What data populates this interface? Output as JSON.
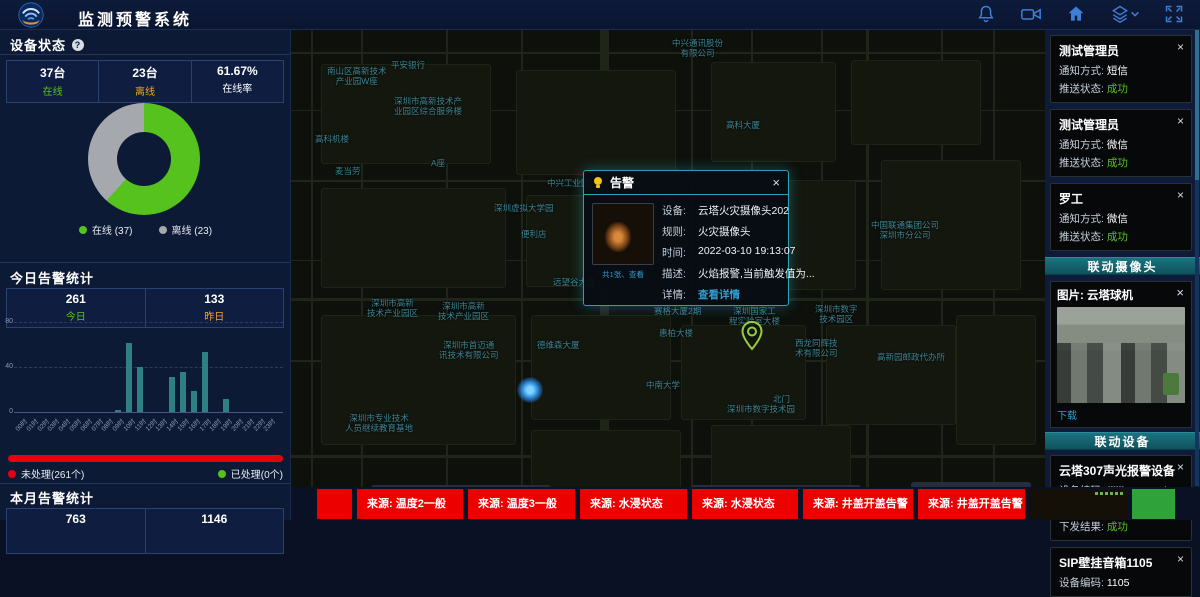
{
  "ui": {
    "close_glyph": "×",
    "help_glyph": "?"
  },
  "header": {
    "title": "监测预警系统",
    "icons": [
      "bell-icon",
      "video-camera-icon",
      "home-icon",
      "layers-icon",
      "fullscreen-icon"
    ]
  },
  "device_status": {
    "title": "设备状态",
    "stats": [
      {
        "value": "37台",
        "label": "在线",
        "label_color": "#56c21d"
      },
      {
        "value": "23台",
        "label": "离线",
        "label_color": "#f5a623"
      },
      {
        "value": "61.67%",
        "label": "在线率",
        "label_color": "#ffffff"
      }
    ],
    "chart_data": {
      "type": "pie",
      "labels": [
        "在线",
        "离线"
      ],
      "values": [
        37,
        23
      ],
      "percent_online": 61.67,
      "colors": [
        "#56c21d",
        "#a5a9ad"
      ],
      "legend": [
        "在线 (37)",
        "离线 (23)"
      ],
      "legend_position": "bottom"
    }
  },
  "today_alarms": {
    "title": "今日告警统计",
    "stats": [
      {
        "value": "261",
        "label": "今日",
        "label_color": "#56c21d"
      },
      {
        "value": "133",
        "label": "昨日",
        "label_color": "#f5a623"
      }
    ],
    "chart_data": {
      "type": "bar",
      "categories": [
        "00时",
        "01时",
        "02时",
        "03时",
        "04时",
        "05时",
        "06时",
        "07时",
        "08时",
        "09时",
        "10时",
        "11时",
        "12时",
        "13时",
        "14时",
        "15时",
        "16时",
        "17时",
        "18时",
        "19时",
        "20时",
        "21时",
        "22时",
        "23时"
      ],
      "values": [
        0,
        0,
        0,
        0,
        0,
        0,
        0,
        0,
        0,
        2,
        61,
        40,
        0,
        0,
        31,
        36,
        19,
        53,
        0,
        12,
        0,
        0,
        0,
        0
      ],
      "ylim": [
        0,
        80
      ],
      "yticks": [
        0,
        40,
        80
      ],
      "bar_color": "#2e8084",
      "grid": "dashed"
    },
    "progress": {
      "unhandled_label": "未处理(261个)",
      "handled_label": "已处理(0个)",
      "unhandled_color": "#e60012",
      "handled_color": "#56c21d",
      "unhandled_ratio": 1
    }
  },
  "month_alarms": {
    "title": "本月告警统计",
    "stats": [
      {
        "value": "763"
      },
      {
        "value": "1146"
      }
    ]
  },
  "map": {
    "labels": [
      {
        "text": "中兴通讯股份\n有限公司",
        "x": 381,
        "y": 8
      },
      {
        "text": "平安银行",
        "x": 100,
        "y": 30
      },
      {
        "text": "南山区高新技术\n产业园W座",
        "x": 36,
        "y": 36
      },
      {
        "text": "深圳市高新技术产\n业园区综合服务楼",
        "x": 103,
        "y": 66
      },
      {
        "text": "高科大厦",
        "x": 435,
        "y": 90
      },
      {
        "text": "高科机楼",
        "x": 24,
        "y": 104
      },
      {
        "text": "A座",
        "x": 140,
        "y": 128
      },
      {
        "text": "麦当劳",
        "x": 44,
        "y": 136
      },
      {
        "text": "中兴工业园",
        "x": 256,
        "y": 148
      },
      {
        "text": "中国联通集团公司\n深圳市分公司",
        "x": 580,
        "y": 190
      },
      {
        "text": "深圳虚拟大学园",
        "x": 203,
        "y": 173
      },
      {
        "text": "便利店",
        "x": 230,
        "y": 199
      },
      {
        "text": "远望谷大厦",
        "x": 262,
        "y": 247
      },
      {
        "text": "深圳市高新\n技术产业园区",
        "x": 76,
        "y": 268
      },
      {
        "text": "深圳市高新\n技术产业园区",
        "x": 147,
        "y": 271
      },
      {
        "text": "赛格大厦2期",
        "x": 363,
        "y": 276
      },
      {
        "text": "深圳国家工\n程实验室大楼",
        "x": 438,
        "y": 276
      },
      {
        "text": "深圳市数字\n技术园区",
        "x": 524,
        "y": 274
      },
      {
        "text": "惠柏大楼",
        "x": 368,
        "y": 298
      },
      {
        "text": "德维森大厦",
        "x": 246,
        "y": 310
      },
      {
        "text": "深圳市首迈通\n讯技术有限公司",
        "x": 148,
        "y": 310
      },
      {
        "text": "西龙同辉技\n术有限公司",
        "x": 504,
        "y": 308
      },
      {
        "text": "高新园邮政代办所",
        "x": 586,
        "y": 322
      },
      {
        "text": "中南大学",
        "x": 355,
        "y": 350
      },
      {
        "text": "北门",
        "x": 482,
        "y": 364
      },
      {
        "text": "深圳市数字技术园",
        "x": 436,
        "y": 374
      },
      {
        "text": "深圳市专业技术\n人员继续教育基地",
        "x": 54,
        "y": 383
      }
    ],
    "pin": {
      "x": 448,
      "y": 290
    },
    "dot": {
      "x": 226,
      "y": 347
    },
    "popup": {
      "title": "告警",
      "thumb_caption": "共1张、查看",
      "fields": [
        {
          "label": "设备:",
          "value": "云塔火灾摄像头202"
        },
        {
          "label": "规则:",
          "value": "火灾摄像头"
        },
        {
          "label": "时间:",
          "value": "2022-03-10 19:13:07"
        },
        {
          "label": "描述:",
          "value": "火焰报警,当前触发值为..."
        },
        {
          "label": "详情:",
          "value": "查看详情",
          "link": true
        }
      ]
    }
  },
  "ticker": {
    "items": [
      {
        "type": "red",
        "text": "",
        "width": 35
      },
      {
        "type": "red",
        "text": "来源: 温度2一般",
        "width": 106
      },
      {
        "type": "red",
        "text": "来源: 温度3一般",
        "width": 107
      },
      {
        "type": "red",
        "text": "来源: 水浸状态",
        "width": 107
      },
      {
        "type": "red",
        "text": "来源: 水浸状态",
        "width": 106
      },
      {
        "type": "red",
        "text": "来源: 井盖开盖告警",
        "width": 110
      },
      {
        "type": "red",
        "text": "来源: 井盖开盖告警",
        "width": 107
      },
      {
        "type": "image",
        "text": "",
        "width": 97
      },
      {
        "type": "green",
        "text": "",
        "width": 43
      }
    ]
  },
  "right_panel": {
    "notifications": [
      {
        "name": "测试管理员",
        "rows": [
          {
            "label": "通知方式:",
            "value": "短信",
            "value_color": "#ffffff"
          },
          {
            "label": "推送状态:",
            "value": "成功",
            "value_color": "#56c21d"
          }
        ]
      },
      {
        "name": "测试管理员",
        "rows": [
          {
            "label": "通知方式:",
            "value": "微信",
            "value_color": "#ffffff"
          },
          {
            "label": "推送状态:",
            "value": "成功",
            "value_color": "#56c21d"
          }
        ]
      },
      {
        "name": "罗工",
        "rows": [
          {
            "label": "通知方式:",
            "value": "微信",
            "value_color": "#ffffff"
          },
          {
            "label": "推送状态:",
            "value": "成功",
            "value_color": "#56c21d"
          }
        ]
      }
    ],
    "camera_section": {
      "header": "联动摄像头",
      "card_title": "图片: 云塔球机",
      "download_label": "下载"
    },
    "device_section": {
      "header": "联动设备",
      "devices": [
        {
          "name": "云塔307声光报警设备",
          "rows": [
            {
              "label": "设备编码:",
              "value": "ffffff100001ab6c",
              "value_color": "#ffffff"
            },
            {
              "label": "调用服务:",
              "value": "报警",
              "value_color": "#ffffff"
            },
            {
              "label": "下发结果:",
              "value": "成功",
              "value_color": "#56c21d"
            }
          ]
        },
        {
          "name": "SIP壁挂音箱1105",
          "rows": [
            {
              "label": "设备编码:",
              "value": "1105",
              "value_color": "#ffffff"
            }
          ]
        }
      ]
    }
  }
}
